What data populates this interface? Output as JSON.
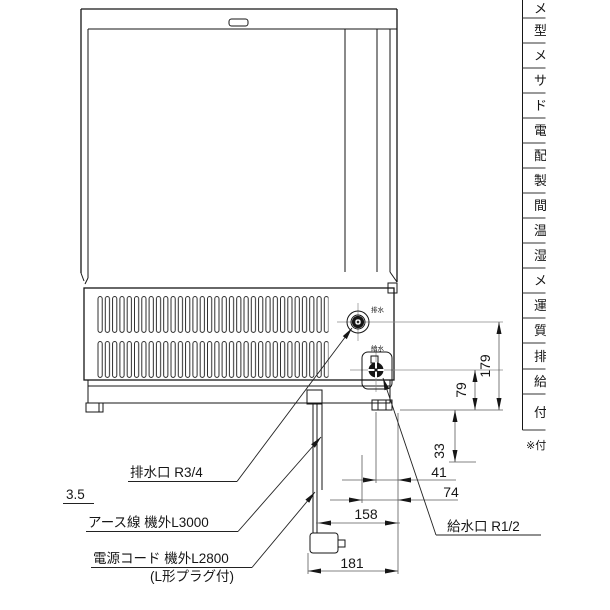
{
  "drawing_title": "rear-view installation drawing",
  "labels": {
    "drain_port": "排水口  R3/4",
    "supply_port": "給水口  R1/2",
    "earth_wire": "アース線  機外L3000",
    "power_cord": "電源コード  機外L2800",
    "power_cord_note": "(L形プラグ付)",
    "clearance": "3.5"
  },
  "port_marks": {
    "drain": "排水",
    "supply": "給水"
  },
  "dims": {
    "d179": "179",
    "d79": "79",
    "d33": "33",
    "d41": "41",
    "d74": "74",
    "d158": "158",
    "d181": "181"
  },
  "table": {
    "fragments": [
      "メ",
      "型",
      "メ",
      "サ",
      "ド",
      "電",
      "配",
      "製",
      "間",
      "温",
      "湿",
      "メ",
      "運",
      "質",
      "排",
      "給",
      "付"
    ],
    "note": "※付"
  },
  "colors": {
    "line": "#161616",
    "dim_line": "#5a5a5a",
    "background": "#ffffff"
  }
}
